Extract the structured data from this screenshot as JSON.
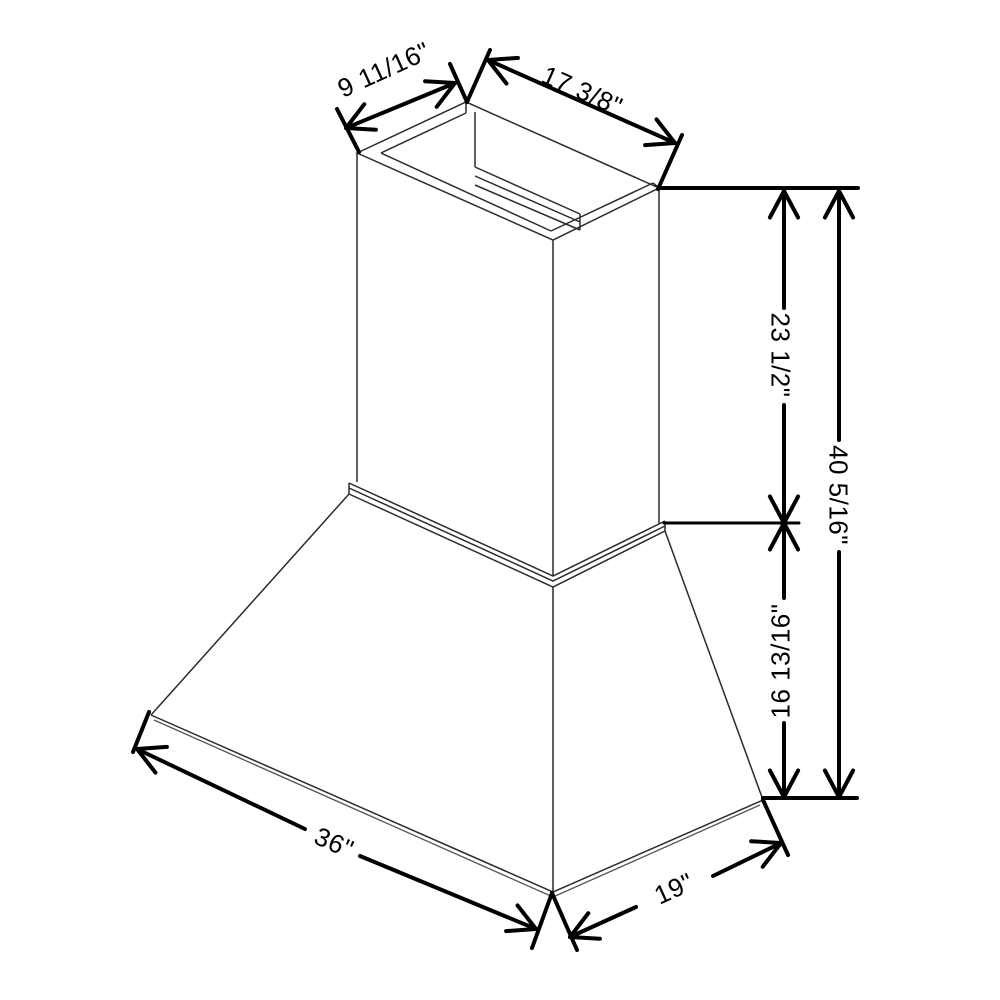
{
  "drawing": {
    "background_color": "#ffffff",
    "object_line_color": "#2b2b2b",
    "dimension_line_color": "#000000",
    "units": "inches",
    "labels": {
      "top_depth": "9 11/16\"",
      "top_width": "17 3/8\"",
      "chimney_height": "23 1/2\"",
      "overall_height": "40 5/16\"",
      "hood_height": "16 13/16\"",
      "base_width": "36\"",
      "base_depth": "19\""
    }
  }
}
